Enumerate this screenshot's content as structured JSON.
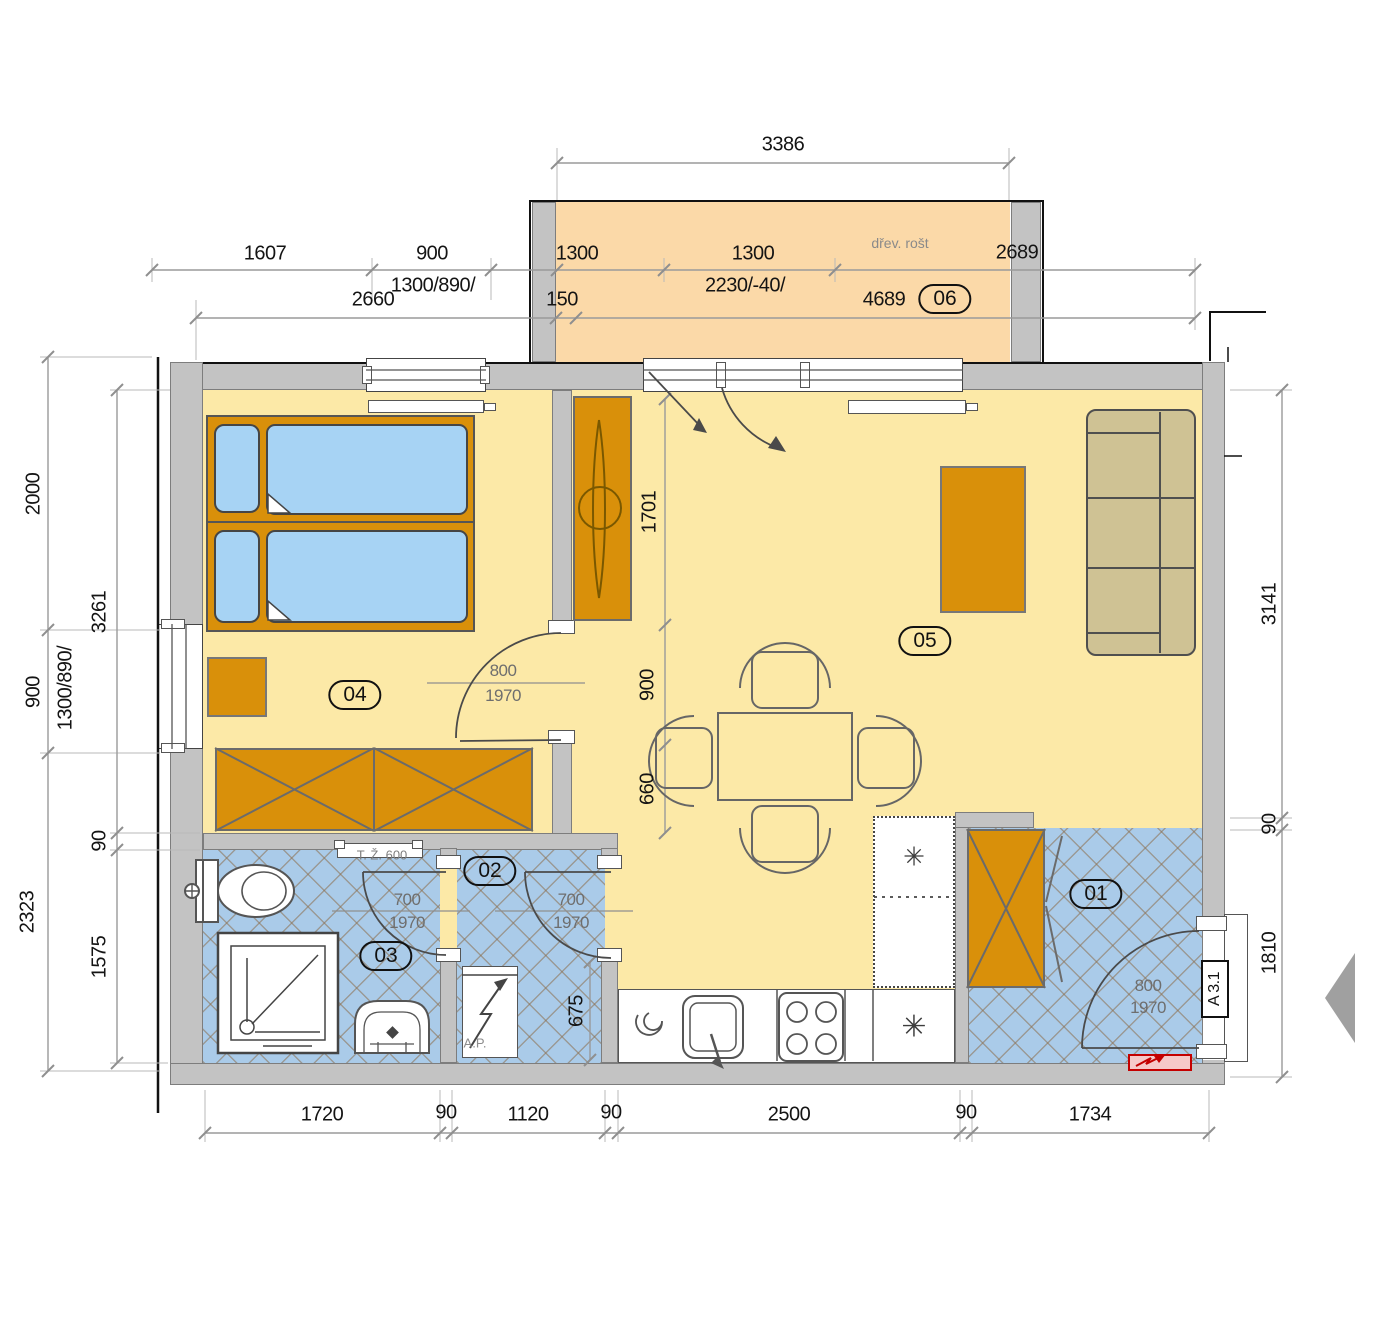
{
  "rooms": {
    "r01": "01",
    "r02": "02",
    "r03": "03",
    "r04": "04",
    "r05": "05",
    "r06": "06"
  },
  "dims_top": {
    "total": "3386",
    "seg1": "1607",
    "seg2": "900",
    "window_spec": "1300/890/",
    "seg3": "2660",
    "panel1": "1300",
    "panel2": "1300",
    "pillar": "150",
    "door_spec": "2230/-40/",
    "balcony_note": "dřev. rošt",
    "seg4": "2689",
    "seg5": "4689"
  },
  "dims_bottom": {
    "seg1": "1720",
    "seg2": "90",
    "seg3": "1120",
    "seg4": "90",
    "seg5": "2500",
    "seg6": "90",
    "seg7": "1734"
  },
  "dims_left": {
    "seg1": "2000",
    "seg2": "900",
    "seg3": "2323",
    "window_spec": "1300/890/",
    "seg4": "3261",
    "seg5": "90",
    "seg6": "1575"
  },
  "dims_right": {
    "seg1": "3141",
    "seg2": "90",
    "seg3": "1810"
  },
  "dims_interior": {
    "wardrobe_wall": "1701",
    "table_clear": "900",
    "table_width": "660",
    "wc_depth": "675"
  },
  "doors": {
    "bedroom_w": "800",
    "bedroom_h": "1970",
    "bath_w": "700",
    "bath_h": "1970",
    "wc_w": "700",
    "wc_h": "1970",
    "entrance_w": "800",
    "entrance_h": "1970"
  },
  "annotations": {
    "towel_rail": "T. Ž. 600",
    "washing_machine": "A.P.",
    "section_mark": "A 3.1"
  },
  "icons": {
    "fridge_star": "✳",
    "freezer_star": "✳"
  },
  "colors": {
    "floor_main": "#fce9a7",
    "floor_wet": "#aacbe9",
    "balcony": "#fbd9a8",
    "furniture": "#d9900a",
    "wall": "#c3c3c3",
    "sofa": "#cfc294",
    "bed": "#a7d3f4",
    "dim_line": "#9a9a9a",
    "alert": "#c40000"
  }
}
